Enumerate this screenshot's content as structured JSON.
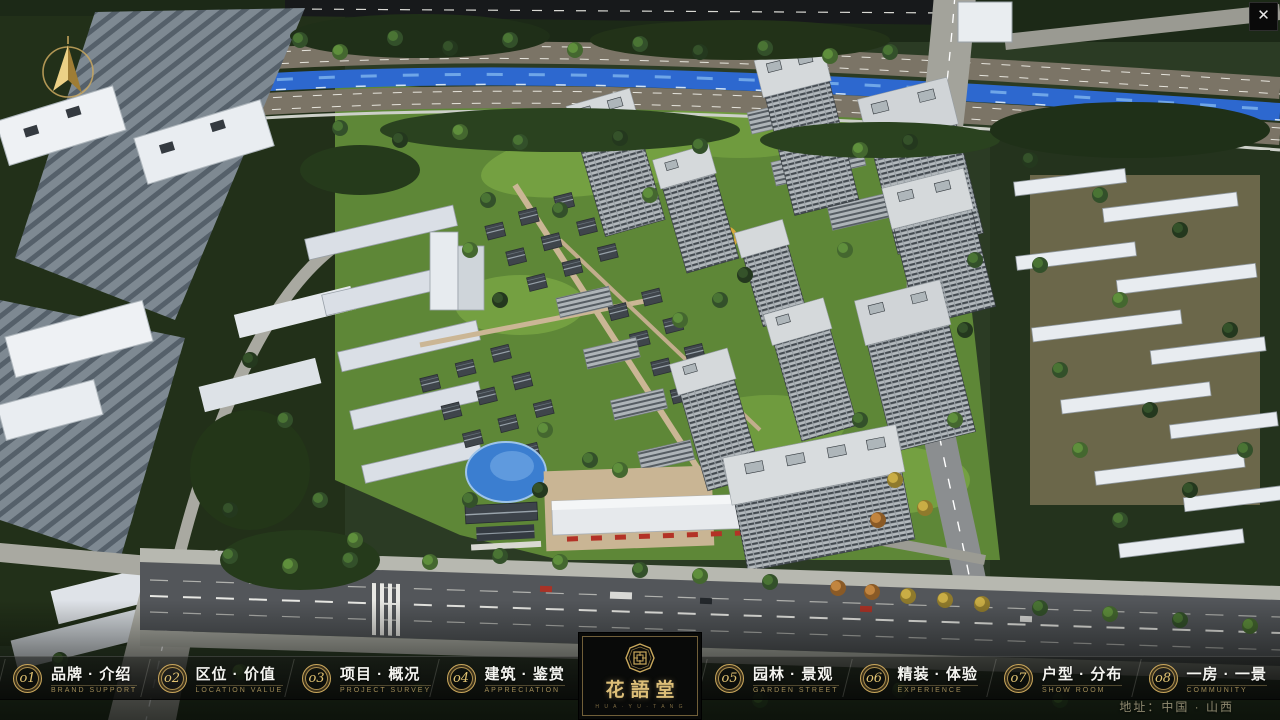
{
  "window": {
    "close_glyph": "✕"
  },
  "scene": {
    "description": "aerial 3D masterplan render of residential community",
    "river_color": "#2d68cf",
    "lawn_color": "#5e8737",
    "accent_gold": "#caa75c"
  },
  "nav": {
    "left_items": [
      {
        "num": "o1",
        "zh": "品牌 · 介绍",
        "en": "BRAND SUPPORT"
      },
      {
        "num": "o2",
        "zh": "区位 · 价值",
        "en": "LOCATION VALUE"
      },
      {
        "num": "o3",
        "zh": "项目 · 概况",
        "en": "PROJECT SURVEY"
      },
      {
        "num": "o4",
        "zh": "建筑 · 鉴赏",
        "en": "APPRECIATION"
      }
    ],
    "right_items": [
      {
        "num": "o5",
        "zh": "园林 · 景观",
        "en": "GARDEN STREET"
      },
      {
        "num": "o6",
        "zh": "精装 · 体验",
        "en": "EXPERIENCE"
      },
      {
        "num": "o7",
        "zh": "户型 · 分布",
        "en": "SHOW ROOM"
      },
      {
        "num": "o8",
        "zh": "一房 · 一景",
        "en": "COMMUNITY"
      }
    ],
    "logo": {
      "title": "花語堂",
      "subtitle": "H U A · Y U · T A N G"
    },
    "address": "地址：中国 · 山西"
  }
}
